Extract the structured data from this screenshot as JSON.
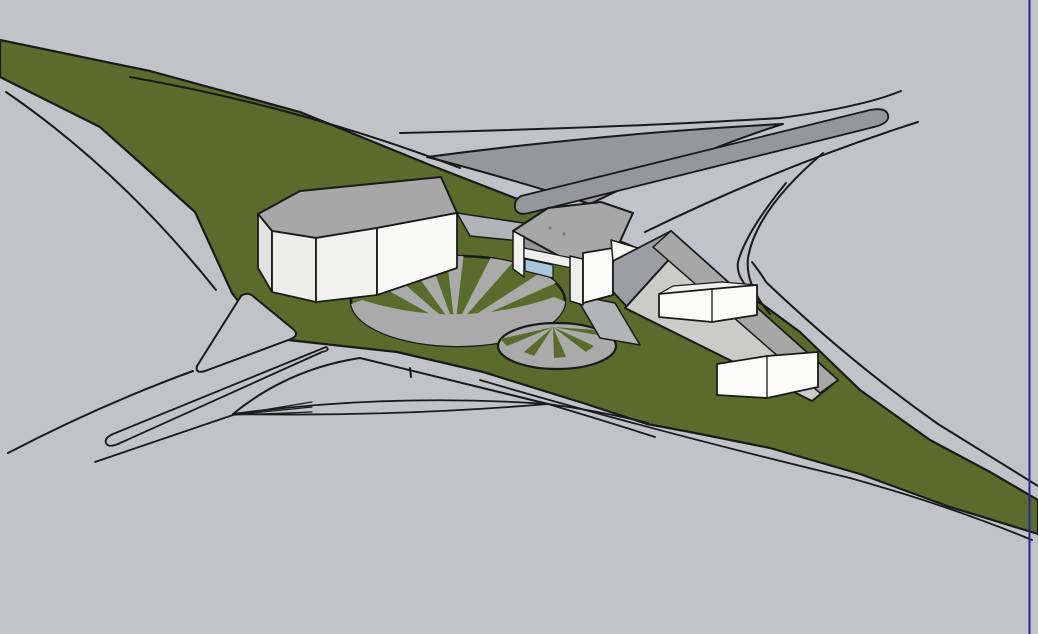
{
  "canvas": {
    "width": 1038,
    "height": 634,
    "background": "#c1c3c9"
  },
  "palette": {
    "background_gray": "#c1c3c9",
    "grass_green": "#5a6b2b",
    "dark_road_gray": "#96979b",
    "plaza_gray": "#a9aaa9",
    "roof_gray": "#a7a7a8",
    "roof_light_gray": "#cbcbc9",
    "wall_white_bright": "#f9f9f7",
    "wall_white_shaded": "#ededeb",
    "wall_gray_face": "#9d9ea1",
    "glass_blue": "#a9c7da",
    "outline_black": "#1a1a1a",
    "page_border_blue": "#2a23a0"
  },
  "scene": {
    "shapes": [
      {
        "name": "viewport-background",
        "type": "rect",
        "x": 0,
        "y": 0,
        "w": 1038,
        "h": 634,
        "fill": "#c1c3c9"
      },
      {
        "name": "grass-median",
        "type": "path",
        "d": "M0,40 L150,71 L300,112 L430,165 L520,200 L610,237 L700,275 L762,304 L800,332 L860,390 L930,440 L990,472 L1038,500 L1038,534 L950,507 L860,474 L770,448 L690,432 L647,424 L583,403 L483,372 L397,352 L288,340 L250,317 L232,293 L195,212 L100,127 L0,77 Z",
        "fill": "#5a6b2b",
        "stroke": "#1a1a1a",
        "sw": 2.2
      },
      {
        "name": "flyover-triangle",
        "type": "path",
        "d": "M427,157 Q610,133 783,124 Q700,150 590,204 Q505,177 427,157 Z",
        "fill": "#96979b",
        "stroke": "#1a1a1a",
        "sw": 2
      },
      {
        "name": "ramp-strip",
        "type": "path",
        "d": "M521,196 L870,110 Q886,107 888,115 Q890,123 874,127 L529,213 Q517,216 515,208 Q514,200 521,196 Z",
        "fill": "#96979b",
        "stroke": "#1a1a1a",
        "sw": 1.8
      },
      {
        "name": "road-edge-upper-left",
        "type": "path",
        "d": "M130,77 Q300,107 460,168",
        "fill": "none",
        "stroke": "#1a1a1a",
        "sw": 2
      },
      {
        "name": "road-edge-lower-left",
        "type": "path",
        "d": "M6,92 Q120,170 216,290",
        "fill": "none",
        "stroke": "#1a1a1a",
        "sw": 2
      },
      {
        "name": "road-edge-top",
        "type": "path",
        "d": "M400,133 Q640,127 780,118 Q862,107 901,91",
        "fill": "none",
        "stroke": "#1a1a1a",
        "sw": 2
      },
      {
        "name": "road-edge-ramp-lower",
        "type": "path",
        "d": "M645,232 Q780,166 918,122",
        "fill": "none",
        "stroke": "#1a1a1a",
        "sw": 2
      },
      {
        "name": "ramp-curve-outer",
        "type": "path",
        "d": "M823,153 Q756,210 748,258 Q745,285 770,314",
        "fill": "none",
        "stroke": "#1a1a1a",
        "sw": 2
      },
      {
        "name": "ramp-curve-inner",
        "type": "path",
        "d": "M786,183 Q746,232 738,262 Q736,275 748,288 Q757,297 763,305",
        "fill": "none",
        "stroke": "#1a1a1a",
        "sw": 2
      },
      {
        "name": "road-edge-right-strip",
        "type": "path",
        "d": "M752,262 Q760,272 766,282 Q850,362 938,424 Q990,456 1038,486",
        "fill": "none",
        "stroke": "#1a1a1a",
        "sw": 2
      },
      {
        "name": "road-edge-bottom-parallel",
        "type": "path",
        "d": "M480,380 Q650,430 850,478 Q950,506 1032,540",
        "fill": "none",
        "stroke": "#1a1a1a",
        "sw": 1.8
      },
      {
        "name": "road-edge-bottom-left-ramp",
        "type": "path",
        "d": "M8,453 Q100,405 193,371",
        "fill": "none",
        "stroke": "#1a1a1a",
        "sw": 2
      },
      {
        "name": "road-edge-merge-line",
        "type": "path",
        "d": "M95,462 L233,415",
        "fill": "none",
        "stroke": "#1a1a1a",
        "sw": 1.8
      },
      {
        "name": "gore-island",
        "type": "path",
        "d": "M241,296 Q248,291 254,297 L293,329 Q300,335 291,339 L205,371 Q195,374 197,366 Z",
        "fill": "#c1c3c9",
        "stroke": "#1a1a1a",
        "sw": 2
      },
      {
        "name": "sliver-island",
        "type": "path",
        "d": "M326,347 L113,434 Q104,438 106,443 Q108,448 118,444 L322,352 Q331,350 326,347 Z",
        "fill": "#c1c3c9",
        "stroke": "#1a1a1a",
        "sw": 1.8
      },
      {
        "name": "lens-island",
        "type": "path",
        "d": "M233,414 Q390,393 548,404 Q390,417 233,414 Z",
        "fill": "#c1c3c9",
        "stroke": "#1a1a1a",
        "sw": 1.8
      },
      {
        "name": "lens-extension-upper",
        "type": "path",
        "d": "M548,404 Q600,411 648,423",
        "fill": "none",
        "stroke": "#1a1a1a",
        "sw": 1.8
      },
      {
        "name": "lens-extension-lower",
        "type": "path",
        "d": "M548,404 Q605,421 655,437",
        "fill": "none",
        "stroke": "#1a1a1a",
        "sw": 1.8
      },
      {
        "name": "hump-curve",
        "type": "path",
        "d": "M233,414 Q288,369 360,358 Q462,383 548,404",
        "fill": "none",
        "stroke": "#1a1a1a",
        "sw": 2
      },
      {
        "name": "merge-nib-line-1",
        "type": "path",
        "d": "M233,415 L312,402",
        "fill": "none",
        "stroke": "#1a1a1a",
        "sw": 1.2
      },
      {
        "name": "merge-nib-line-2",
        "type": "path",
        "d": "M233,415 L312,407",
        "fill": "none",
        "stroke": "#1a1a1a",
        "sw": 1.2
      },
      {
        "name": "merge-nib-line-3",
        "type": "path",
        "d": "M233,415 L312,412",
        "fill": "none",
        "stroke": "#1a1a1a",
        "sw": 1.2
      },
      {
        "name": "small-post-mark",
        "type": "path",
        "d": "M410,368 L411,377",
        "fill": "none",
        "stroke": "#1a1a1a",
        "sw": 2
      },
      {
        "name": "plaza-large-clip",
        "type": "clipEllipse",
        "id": "clipA",
        "cx": 458,
        "cy": 301,
        "rx": 107,
        "ry": 45
      },
      {
        "name": "plaza-large",
        "type": "ellipse",
        "cx": 458,
        "cy": 301,
        "rx": 107,
        "ry": 45,
        "fill": "#5a6b2b",
        "stroke": "#1a1a1a",
        "sw": 2.5
      },
      {
        "name": "plaza-large-paving-base",
        "type": "path",
        "d": "M330,312 L362,300 Q458,330 554,297 L586,310 L586,350 L330,350 Z",
        "fill": "#a9aaa9",
        "clip": "clipA"
      },
      {
        "name": "plaza-large-ray-1",
        "type": "path",
        "d": "M455,328 L352,270 L378,261 Z",
        "fill": "#a9aaa9",
        "clip": "clipA"
      },
      {
        "name": "plaza-large-ray-2",
        "type": "path",
        "d": "M455,328 L405,258 L428,254 Z",
        "fill": "#a9aaa9",
        "clip": "clipA"
      },
      {
        "name": "plaza-large-ray-3",
        "type": "path",
        "d": "M455,328 L446,252 L464,252 Z",
        "fill": "#a9aaa9",
        "clip": "clipA"
      },
      {
        "name": "plaza-large-ray-4",
        "type": "path",
        "d": "M455,328 L492,255 L514,261 Z",
        "fill": "#a9aaa9",
        "clip": "clipA"
      },
      {
        "name": "plaza-large-ray-5",
        "type": "path",
        "d": "M455,328 L543,271 L560,281 Z",
        "fill": "#a9aaa9",
        "clip": "clipA"
      },
      {
        "name": "plaza-small-clip",
        "type": "clipEllipse",
        "id": "clipB",
        "cx": 557,
        "cy": 346,
        "rx": 59,
        "ry": 23
      },
      {
        "name": "plaza-small",
        "type": "ellipse",
        "cx": 557,
        "cy": 346,
        "rx": 59,
        "ry": 23,
        "fill": "#a9aaa9",
        "stroke": "#1a1a1a",
        "sw": 2.2
      },
      {
        "name": "plaza-small-wedge-1",
        "type": "path",
        "d": "M553,327 L500,339 L507,346 Z",
        "fill": "#5a6b2b",
        "clip": "clipB"
      },
      {
        "name": "plaza-small-wedge-2",
        "type": "path",
        "d": "M553,327 L524,352 L534,356 Z",
        "fill": "#5a6b2b",
        "clip": "clipB"
      },
      {
        "name": "plaza-small-wedge-3",
        "type": "path",
        "d": "M553,327 L554,358 L566,357 Z",
        "fill": "#5a6b2b",
        "clip": "clipB"
      },
      {
        "name": "plaza-small-wedge-4",
        "type": "path",
        "d": "M553,327 L586,352 L594,346 Z",
        "fill": "#5a6b2b",
        "clip": "clipB"
      },
      {
        "name": "plaza-small-wedge-5",
        "type": "path",
        "d": "M553,327 L608,337 L611,331 Z",
        "fill": "#5a6b2b",
        "clip": "clipB"
      },
      {
        "name": "walkway-between-buildings",
        "type": "polygon",
        "points": "457,213 530,224 530,242 470,236",
        "fill": "#b2b4b8",
        "stroke": "#1a1a1a",
        "sw": 1.5
      },
      {
        "name": "walkway-mid-right",
        "type": "polygon",
        "points": "575,295 615,303 640,345 600,338",
        "fill": "#b2b4b8",
        "stroke": "#1a1a1a",
        "sw": 1.5
      },
      {
        "name": "left-building-roof",
        "type": "polygon",
        "points": "258,214 300,191 441,177 457,213 377,228 316,238 272,231",
        "fill": "#a7a7a8",
        "stroke": "#1a1a1a",
        "sw": 2
      },
      {
        "name": "left-building-side-face",
        "type": "polygon",
        "points": "258,214 272,231 272,292 258,268",
        "fill": "#e2e2e0",
        "stroke": "#1a1a1a",
        "sw": 1.8
      },
      {
        "name": "left-building-face-a",
        "type": "polygon",
        "points": "272,231 316,238 316,302 272,292",
        "fill": "#ededeb",
        "stroke": "#1a1a1a",
        "sw": 1.8
      },
      {
        "name": "left-building-face-b",
        "type": "polygon",
        "points": "316,238 377,228 377,295 316,302",
        "fill": "#f1f1ef",
        "stroke": "#1a1a1a",
        "sw": 1.8
      },
      {
        "name": "left-building-face-c",
        "type": "polygon",
        "points": "377,228 457,213 457,268 377,295",
        "fill": "#f9f9f7",
        "stroke": "#1a1a1a",
        "sw": 1.8
      },
      {
        "name": "mid-building-shadow-band",
        "type": "polygon",
        "points": "524,237 612,259 610,268 524,248",
        "fill": "#97979b",
        "stroke": "#1a1a1a",
        "sw": 1.2
      },
      {
        "name": "mid-building-roof",
        "type": "polygon",
        "points": "513,231 548,208 601,202 633,213 612,259 570,262",
        "fill": "#a7a7a8",
        "stroke": "#1a1a1a",
        "sw": 2
      },
      {
        "name": "mid-building-roof-vent-1",
        "type": "circle",
        "cx": 550,
        "cy": 228,
        "r": 1.6,
        "fill": "#787878"
      },
      {
        "name": "mid-building-roof-vent-2",
        "type": "circle",
        "cx": 564,
        "cy": 234,
        "r": 1.6,
        "fill": "#787878"
      },
      {
        "name": "mid-building-pier-left",
        "type": "polygon",
        "points": "513,231 524,237 524,277 513,269",
        "fill": "#f2f2f0",
        "stroke": "#1a1a1a",
        "sw": 1.5
      },
      {
        "name": "mid-building-beam",
        "type": "polygon",
        "points": "524,248 576,259 576,269 524,258",
        "fill": "#efefed",
        "stroke": "#1a1a1a",
        "sw": 1.2
      },
      {
        "name": "mid-building-glass-wall",
        "type": "polygon",
        "points": "525,259 553,265 553,278 525,271",
        "fill": "#a9c7da",
        "stroke": "#1a1a1a",
        "sw": 1.2
      },
      {
        "name": "mid-building-pier-right",
        "type": "polygon",
        "points": "570,256 583,259 583,305 570,301",
        "fill": "#eeeeec",
        "stroke": "#1a1a1a",
        "sw": 1.5
      },
      {
        "name": "mid-building-front-wall",
        "type": "polygon",
        "points": "583,253 613,248 613,295 583,303",
        "fill": "#fbfbf9",
        "stroke": "#1a1a1a",
        "sw": 1.8
      },
      {
        "name": "right-building-tip-triangle",
        "type": "polygon",
        "points": "611,240 651,252 613,261",
        "fill": "#f5f5f3",
        "stroke": "#1a1a1a",
        "sw": 1.5
      },
      {
        "name": "right-building-end-face",
        "type": "polygon",
        "points": "613,261 671,231 680,247 632,312 613,292",
        "fill": "#9d9ea1",
        "stroke": "#1a1a1a",
        "sw": 1.8
      },
      {
        "name": "right-building-roof-lower-slope",
        "type": "polygon",
        "points": "671,231 838,380 812,401 625,308 683,244",
        "fill": "#cbcbc9",
        "stroke": "#1a1a1a",
        "sw": 2
      },
      {
        "name": "right-building-roof-upper-slope",
        "type": "polygon",
        "points": "671,231 838,380 820,393 653,247",
        "fill": "#a7a7a8",
        "stroke": "#1a1a1a",
        "sw": 1.5
      },
      {
        "name": "right-building-clerestory-top",
        "type": "polygon",
        "points": "659,294 673,286 722,282 757,285 712,289",
        "fill": "#f0f0ee",
        "stroke": "#1a1a1a",
        "sw": 1.2
      },
      {
        "name": "right-building-clerestory-front",
        "type": "polygon",
        "points": "659,294 712,289 757,285 757,315 712,322 659,317",
        "fill": "#fbfbf9",
        "stroke": "#1a1a1a",
        "sw": 1.8
      },
      {
        "name": "right-building-clerestory-divider",
        "type": "path",
        "d": "M712,289 L712,322",
        "fill": "none",
        "stroke": "#1a1a1a",
        "sw": 1.3
      },
      {
        "name": "right-building-lower-wall-front",
        "type": "polygon",
        "points": "717,364 767,356 818,352 818,387 767,398 717,395",
        "fill": "#fbfbf9",
        "stroke": "#1a1a1a",
        "sw": 1.8
      },
      {
        "name": "right-building-lower-wall-divider",
        "type": "path",
        "d": "M767,356 L767,398",
        "fill": "none",
        "stroke": "#1a1a1a",
        "sw": 1.3
      },
      {
        "name": "page-border-line",
        "type": "line",
        "x1": 1029.5,
        "y1": 0,
        "x2": 1029.5,
        "y2": 634,
        "stroke": "#2a23a0",
        "sw": 2
      }
    ]
  }
}
